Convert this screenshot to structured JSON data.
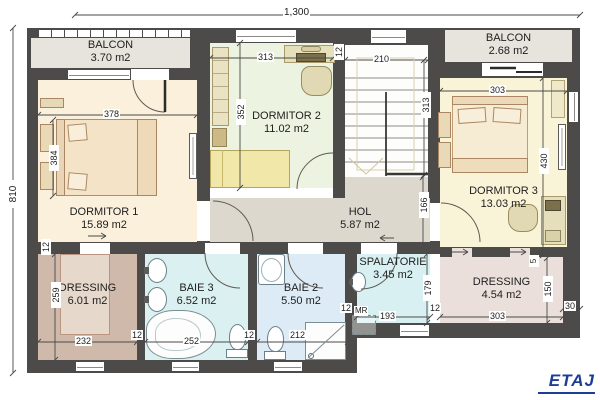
{
  "floor": {
    "label": "ETAJ"
  },
  "rooms": {
    "balcon_left": {
      "name": "BALCON",
      "area": "3.70 m2"
    },
    "balcon_right": {
      "name": "BALCON",
      "area": "2.68 m2"
    },
    "dormitor1": {
      "name": "DORMITOR 1",
      "area": "15.89 m2"
    },
    "dormitor2": {
      "name": "DORMITOR 2",
      "area": "11.02 m2"
    },
    "dormitor3": {
      "name": "DORMITOR 3",
      "area": "13.03 m2"
    },
    "hol": {
      "name": "HOL",
      "area": "5.87 m2"
    },
    "dressing_left": {
      "name": "DRESSING",
      "area": "6.01 m2"
    },
    "baie3": {
      "name": "BAIE 3",
      "area": "6.52 m2"
    },
    "baie2": {
      "name": "BAIE 2",
      "area": "5.50 m2"
    },
    "spalatorie": {
      "name": "SPALATORIE",
      "area": "3.45 m2"
    },
    "dressing_right": {
      "name": "DRESSING",
      "area": "4.54 m2"
    }
  },
  "dims": {
    "overall_width": "1,300",
    "overall_height": "810",
    "d378": "378",
    "d384": "384",
    "d313": "313",
    "d352": "352",
    "d210": "210",
    "d303": "303",
    "d430": "430",
    "d166": "166",
    "d259": "259",
    "d232": "232",
    "d252": "252",
    "d212": "212",
    "d193": "193",
    "d179": "179",
    "d150": "150",
    "d30": "30",
    "d5": "5",
    "d12": "12",
    "washer": "MR"
  },
  "colors": {
    "wall": "#4c4b49",
    "floor_label_accent": "#1c3e96",
    "balcon_floor": "#e7e4de",
    "dormitor1_floor": "#faf0dc",
    "dormitor2_floor": "#ecf3e0",
    "dormitor3_floor": "#f9f4d8",
    "hol_floor": "#dcd8ce",
    "dressing_left_floor": "#cfb9ab",
    "dressing_right_floor": "#ebdfdc",
    "baie3_floor": "#dbf1f1",
    "baie2_floor": "#ddebf7",
    "spalatorie_floor": "#d9f0f2"
  }
}
